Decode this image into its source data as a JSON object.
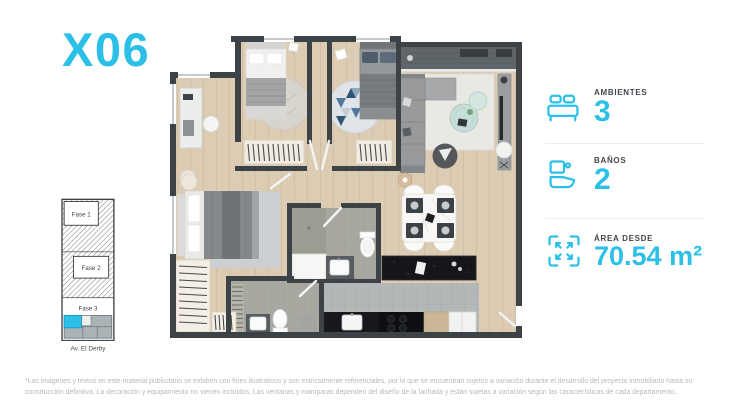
{
  "accent_color": "#2cc0e8",
  "wall_color": "#3d4247",
  "header": {
    "title": "X06"
  },
  "stats": [
    {
      "icon": "bed-icon",
      "label": "AMBIENTES",
      "value": "3"
    },
    {
      "icon": "toilet-icon",
      "label": "BAÑOS",
      "value": "2"
    },
    {
      "icon": "area-icon",
      "label": "ÁREA DESDE",
      "value": "70.54 m²"
    }
  ],
  "location_map": {
    "phases": [
      "Fase 1",
      "Fase 2",
      "Fase 3"
    ],
    "street_label": "Av. El Derby",
    "highlighted_unit": "X06",
    "highlight_color": "#2cc0e8"
  },
  "disclaimer": "*Las imágenes y textos en este material publicitario se exhiben con fines ilustrativos y son estrictamente referenciales, por lo que se encuentran sujetos a variación durante el desarrollo del proyecto inmobiliario hasta su construcción definitiva. La decoración y equipamiento no vienen incluidos. Las ventanas y mamparas dependen del diseño de la fachada y están sujetas a variación según las características de cada departamento."
}
